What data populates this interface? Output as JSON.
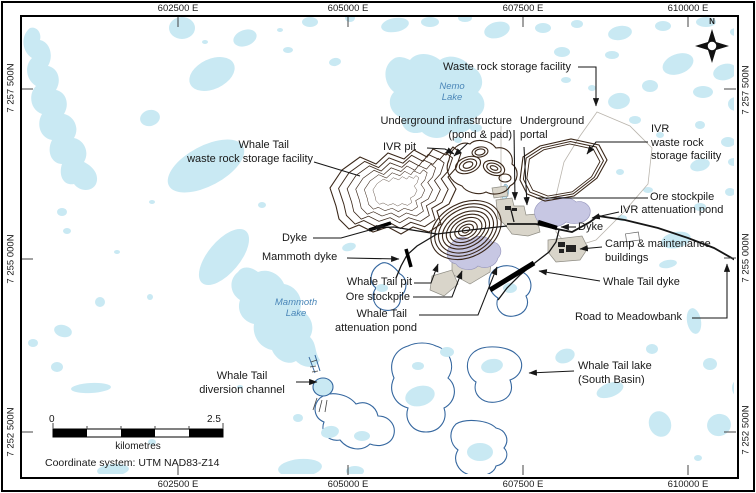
{
  "map": {
    "north_indicator": "N",
    "edge_coordinates": {
      "top": [
        "602500 E",
        "605000 E",
        "607500 E",
        "610000 E"
      ],
      "bottom": [
        "602500 E",
        "605000 E",
        "607500 E",
        "610000 E"
      ],
      "left": [
        "7 257 500N",
        "7 255 000N",
        "7 252 500N"
      ],
      "right": [
        "7 257 500N",
        "7 255 000N",
        "7 252 500N"
      ]
    },
    "feature_labels": {
      "waste_rock_storage_facility": "Waste rock storage facility",
      "underground_infrastructure_line1": "Underground infrastructure",
      "underground_infrastructure_line2": "(pond & pad)",
      "underground_portal_line1": "Underground",
      "underground_portal_line2": "portal",
      "ivr_pit": "IVR pit",
      "ivr_wrsf_line1": "IVR",
      "ivr_wrsf_line2": "waste rock",
      "ivr_wrsf_line3": "storage facility",
      "whale_tail_wrsf_line1": "Whale Tail",
      "whale_tail_wrsf_line2": "waste rock storage facility",
      "dyke_west": "Dyke",
      "mammoth_dyke": "Mammoth dyke",
      "whale_tail_pit": "Whale Tail pit",
      "ore_stockpile_south": "Ore stockpile",
      "whale_tail_attenuation_line1": "Whale Tail",
      "whale_tail_attenuation_line2": "attenuation pond",
      "ore_stockpile_east": "Ore stockpile",
      "ivr_attenuation_pond": "IVR attenuation pond",
      "dyke_east": "Dyke",
      "camp_line1": "Camp & maintenance",
      "camp_line2": "buildings",
      "whale_tail_dyke": "Whale Tail dyke",
      "road_to_meadowbank": "Road to Meadowbank",
      "whale_tail_lake_line1": "Whale Tail lake",
      "whale_tail_lake_line2": "(South Basin)",
      "diversion_line1": "Whale Tail",
      "diversion_line2": "diversion channel"
    },
    "lake_names": {
      "nemo_line1": "Nemo",
      "nemo_line2": "Lake",
      "mammoth_line1": "Mammoth",
      "mammoth_line2": "Lake"
    },
    "scale_bar": {
      "start_value": "0",
      "end_value": "2.5",
      "unit": "kilometres"
    },
    "coordinate_system_note": "Coordinate system: UTM NAD83-Z14",
    "colors": {
      "lake": "#c9e9f3",
      "lakeline": "#35679f",
      "pond": "#c7c7e3",
      "pad": "#d9d5ca",
      "contour": "#3a2719",
      "road": "#161616"
    }
  }
}
